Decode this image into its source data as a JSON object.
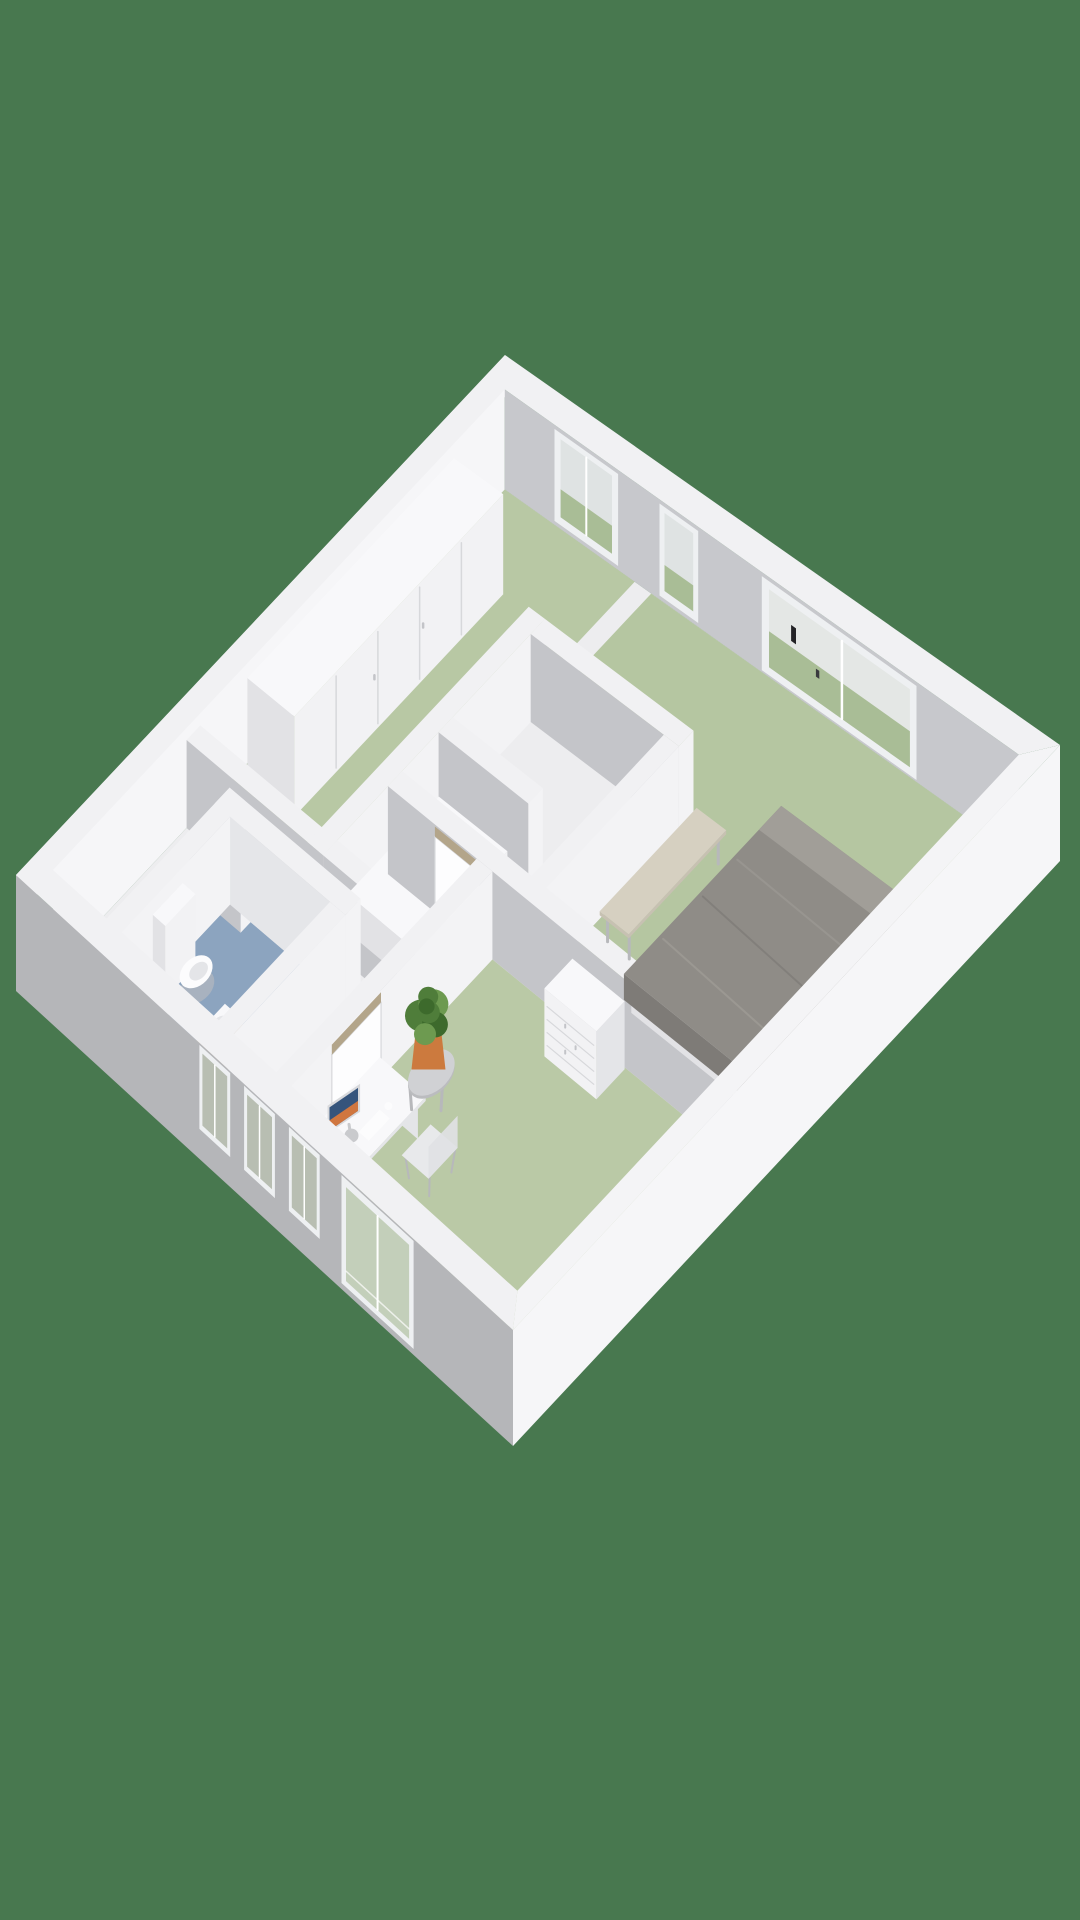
{
  "scene": {
    "label": "3D floor plan render",
    "background": "#48784f"
  },
  "palette": {
    "rim": "#f1f1f3",
    "rim2": "#f4f4f6",
    "wall_white": "#f3f3f5",
    "wall_inner_nw": "#f6f6f8",
    "wall_outer_nw": "#eff0f2",
    "wall_gray": "#c4c5c9",
    "wall_inner_ne": "#c7c8cc",
    "wall_light": "#e5e6e9",
    "wall_outer_sw": "#b5b6b9",
    "wall_outer_se": "#f6f6f8",
    "win_frame": "#eef0f2",
    "win_glass": "#dfe3e3",
    "win_glass2": "#e4e7e5",
    "sage_out": "#a9bd96",
    "sw_glass": "#b8beb2",
    "sw_glass2": "#c3cfba",
    "shaft_dark": "#9b9c9f",
    "seam": "#d7d8db",
    "seam_dark": "#c3c4c8",
    "furn_front": "#f2f2f4",
    "furn_side": "#e2e2e5",
    "furn_side2": "#e4e5e8",
    "furn_top": "#f8f8fa",
    "pillow": "#fcfcfd",
    "door": "#fdfdfe",
    "tan": "#b3a58a",
    "tan_dark": "#a39578",
    "duvet": "#8f8c87",
    "duvet_dark": "#7e7b77",
    "duvet_mid": "#868380",
    "duvet_hi": "#a19e98",
    "duvet_sh": "#7b7874",
    "bench": "#d6d0c1",
    "bench_dark": "#c7c1b2",
    "leg": "#b7b8bb",
    "metal": "#c9cacd",
    "chair": "#e8e9eb",
    "chair_back": "#e0e1e4",
    "table": "#d0d1d4",
    "table_dark": "#bbbcbf",
    "pot": "#cc7a3e",
    "pot_light": "#d98c55",
    "leaf": "#4f7d3a",
    "leaf_light": "#6d9a50",
    "leaf_dark": "#3d6a2c",
    "screen_frame": "#d8d9dc",
    "screen_blue": "#35547c",
    "screen_orange": "#d0763f",
    "dark": "#232326",
    "dark2": "#3a3a3e",
    "white": "#ffffff"
  },
  "rooms": [
    {
      "id": "hallway",
      "name": "hallway",
      "floor_color": "#ededef"
    },
    {
      "id": "dressing-room",
      "name": "dressing room",
      "floor_color": "#b8c8a4"
    },
    {
      "id": "bedroom",
      "name": "bedroom",
      "floor_color": "#b5c6a1"
    },
    {
      "id": "study",
      "name": "study",
      "floor_color": "#bac9a6"
    },
    {
      "id": "toilet",
      "name": "toilet",
      "floor_color": "#8ca4bf"
    }
  ],
  "furniture": [
    "wardrobe",
    "single-bed",
    "double-bed",
    "bench",
    "dresser",
    "desk",
    "monitor",
    "keyboard",
    "mouse",
    "desk-chair",
    "side-table",
    "potted-plant",
    "toilet-bowl",
    "cistern",
    "sink-vanity",
    "radiator"
  ],
  "openings": [
    "ne-window-dressing",
    "ne-window-nook",
    "ne-window-bedroom",
    "sw-window-1",
    "sw-window-2",
    "sw-window-3",
    "sw-patio-window",
    "bedroom-door-with-transom",
    "study-door-with-transom"
  ]
}
